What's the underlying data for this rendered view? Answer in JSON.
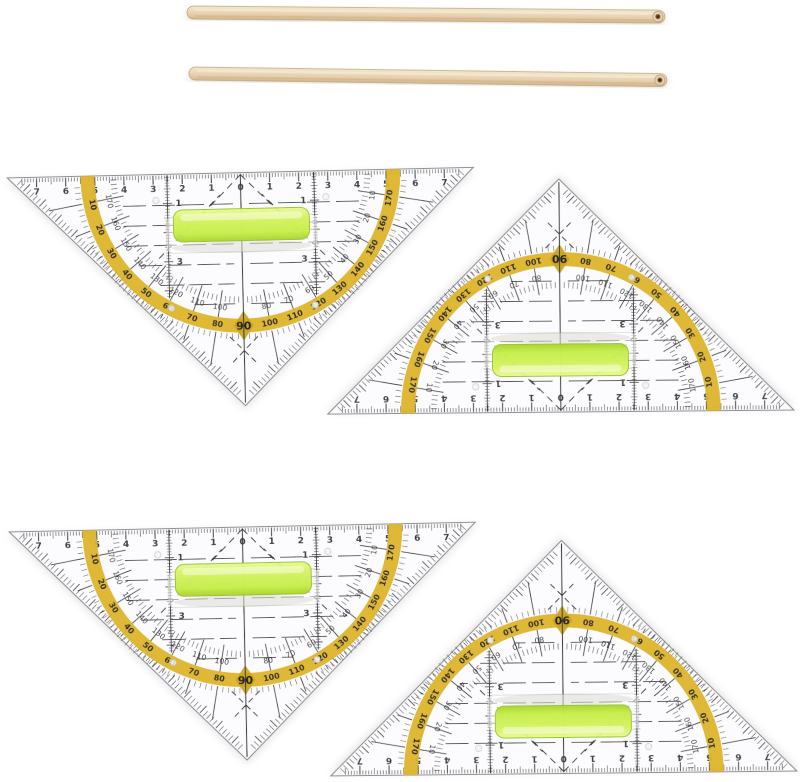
{
  "scene": {
    "background": "#ffffff"
  },
  "wooden_sticks": {
    "count": 2,
    "wood_color": "#ecdabc",
    "wood_highlight": "#f5ead4",
    "wood_edge_color": "#cfb28a",
    "tip_hole_color": "#3a2b1a",
    "instances": [
      {
        "name": "stick-top",
        "position": "top"
      },
      {
        "name": "stick-bottom",
        "position": "below-top"
      }
    ]
  },
  "set_squares": {
    "count": 4,
    "body_color": "#fcfcfe",
    "outline_color": "#8f8f94",
    "marking_color": "#3c3c3c",
    "band_color": "#ddb42a",
    "band_dark": "#c9a318",
    "grip_color": "#c6ee4a",
    "grip_highlight": "#e9fa93",
    "cm_labels": [
      "7",
      "6",
      "5",
      "4",
      "3",
      "2",
      "1",
      "0",
      "1",
      "2",
      "3",
      "4",
      "5",
      "6",
      "7"
    ],
    "parallel_scale_labels": [
      "1",
      "2",
      "3"
    ],
    "protractor": {
      "angles": [
        170,
        160,
        150,
        140,
        130,
        120,
        110,
        100,
        80,
        70,
        60,
        50,
        40,
        30,
        20,
        10
      ],
      "outer_labels": [
        "10",
        "20",
        "30",
        "40",
        "50",
        "60",
        "70",
        "80",
        "100",
        "110",
        "120",
        "130",
        "140",
        "150",
        "160",
        "170"
      ],
      "inner_labels": [
        "170",
        "160",
        "150",
        "140",
        "130",
        "120",
        "110",
        "100",
        "80",
        "70",
        "60",
        "50",
        "40",
        "30",
        "20",
        "10"
      ],
      "center_label": "90"
    },
    "instances": [
      {
        "name": "set-square-top-left",
        "orientation": "pointing-down"
      },
      {
        "name": "set-square-top-right",
        "orientation": "pointing-up"
      },
      {
        "name": "set-square-bottom-left",
        "orientation": "pointing-down"
      },
      {
        "name": "set-square-bottom-right",
        "orientation": "pointing-up"
      }
    ]
  }
}
